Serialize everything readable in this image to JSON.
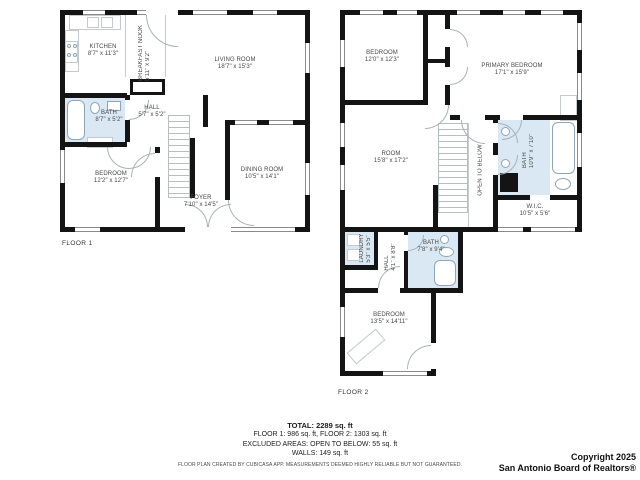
{
  "floor1": {
    "label": "FLOOR 1",
    "rooms": {
      "kitchen": {
        "name": "KITCHEN",
        "dims": "8'7\" x 11'3\""
      },
      "breakfast_nook": {
        "name": "BREAKFAST NOOK",
        "dims": "5'11\" x 9'2\""
      },
      "living_room": {
        "name": "LIVING ROOM",
        "dims": "18'7\" x 15'3\""
      },
      "bath": {
        "name": "BATH",
        "dims": "8'7\" x 5'2\""
      },
      "hall": {
        "name": "HALL",
        "dims": "5'7\" x 5'2\""
      },
      "bedroom": {
        "name": "BEDROOM",
        "dims": "12'2\" x 12'7\""
      },
      "dining_room": {
        "name": "DINING ROOM",
        "dims": "10'5\" x 14'1\""
      },
      "foyer": {
        "name": "FOYER",
        "dims": "7'10\" x 14'5\""
      }
    }
  },
  "floor2": {
    "label": "FLOOR 2",
    "rooms": {
      "bedroom_top": {
        "name": "BEDROOM",
        "dims": "12'0\" x 12'3\""
      },
      "primary_bedroom": {
        "name": "PRIMARY BEDROOM",
        "dims": "17'1\" x 15'9\""
      },
      "room": {
        "name": "ROOM",
        "dims": "15'8\" x 17'2\""
      },
      "open_to_below": {
        "name": "OPEN TO BELOW"
      },
      "bath_top": {
        "name": "BATH",
        "dims": "10'9\" x 7'10\""
      },
      "wic": {
        "name": "W.I.C.",
        "dims": "10'5\" x 5'6\""
      },
      "laundry": {
        "name": "LAUNDRY",
        "dims": "5'3\" x 5'5\""
      },
      "hall": {
        "name": "HALL",
        "dims": "4'1\" x 8'8\""
      },
      "bath_bottom": {
        "name": "BATH",
        "dims": "7'8\" x 9'4\""
      },
      "bedroom_bottom": {
        "name": "BEDROOM",
        "dims": "13'5\" x 14'11\""
      }
    }
  },
  "summary": {
    "total": "TOTAL: 2289 sq. ft",
    "floors": "FLOOR 1: 986 sq. ft, FLOOR 2: 1303 sq. ft",
    "excluded": "EXCLUDED AREAS: OPEN TO BELOW: 55 sq. ft",
    "walls": "WALLS: 149 sq. ft",
    "disclaimer": "FLOOR PLAN CREATED BY CUBICASA APP. MEASUREMENTS DEEMED HIGHLY RELIABLE BUT NOT GUARANTEED."
  },
  "copyright": {
    "line1": "Copyright 2025",
    "line2": "San Antonio Board of Realtors®"
  },
  "colors": {
    "wall": "#141414",
    "wet_room": "#d9e8f3",
    "fixture_outline": "#8fa6b8"
  }
}
